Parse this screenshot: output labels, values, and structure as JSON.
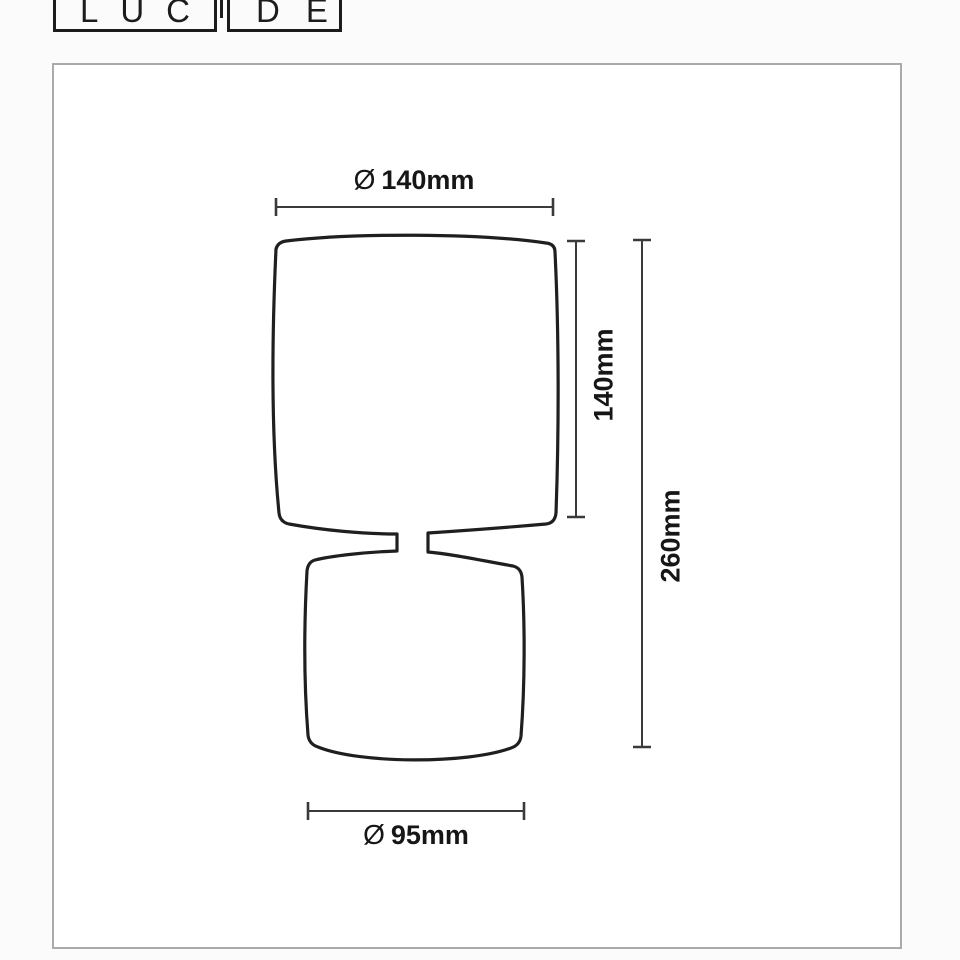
{
  "logo": {
    "left": "LUC",
    "right": "DE"
  },
  "dimensions": {
    "shade_diameter": {
      "symbol": "Ø",
      "value": "140mm"
    },
    "shade_height": "140mm",
    "total_height": "260mm",
    "base_diameter": {
      "symbol": "Ø",
      "value": "95mm"
    }
  },
  "colors": {
    "lamp_outline": "#1f1f1f",
    "dimension_lines": "#3a3a3a",
    "label_text": "#161616",
    "frame_border": "#aaaaaa",
    "logo_ink": "#1c1c1c",
    "background": "#fbfbfb"
  }
}
